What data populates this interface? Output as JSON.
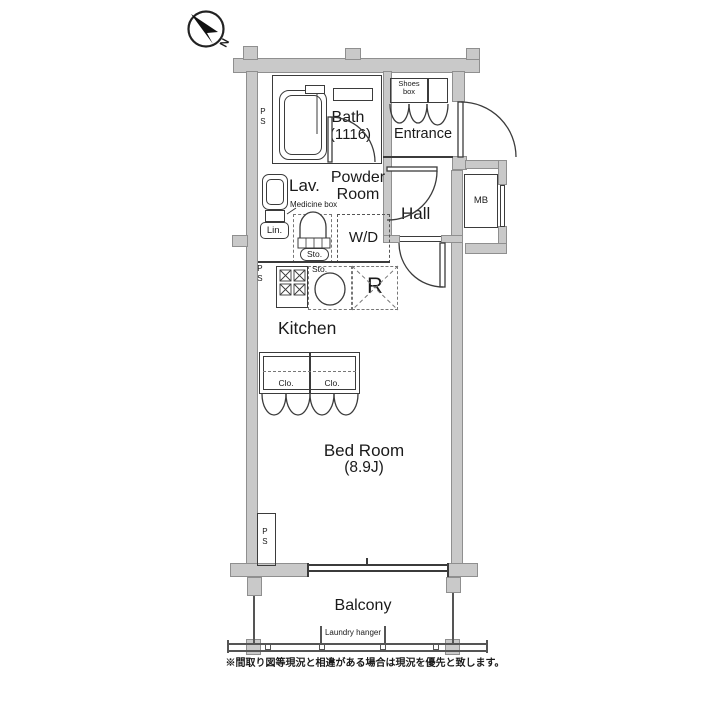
{
  "labels": {
    "compass_north": "N",
    "bath_name": "Bath",
    "bath_size": "(1116)",
    "shoes_box": "Shoes\nbox",
    "entrance": "Entrance",
    "powder_room": "Powder\nRoom",
    "lav": "Lav.",
    "medicine_box": "Medicine box",
    "hall": "Hall",
    "mb": "MB",
    "lin": "Lin.",
    "sto_powder": "Sto.",
    "wd": "W/D",
    "ps_top": "PS",
    "ps_mid": "PS",
    "ps_bottom": "PS",
    "sto_kitchen": "Sto.",
    "fridge": "R",
    "kitchen": "Kitchen",
    "closet_left": "Clo.",
    "closet_right": "Clo.",
    "bedroom_name": "Bed Room",
    "bedroom_size": "(8.9J)",
    "balcony": "Balcony",
    "laundry_hanger": "Laundry hanger",
    "footer_note": "※間取り図等現況と相違がある場合は現況を優先と致します。"
  },
  "colors": {
    "wall_fill": "#c9c9c9",
    "wall_edge": "#8f8f8f",
    "line": "#3b3b3b",
    "dashed_line": "#777777",
    "text": "#1a1a1a",
    "background": "#ffffff"
  }
}
